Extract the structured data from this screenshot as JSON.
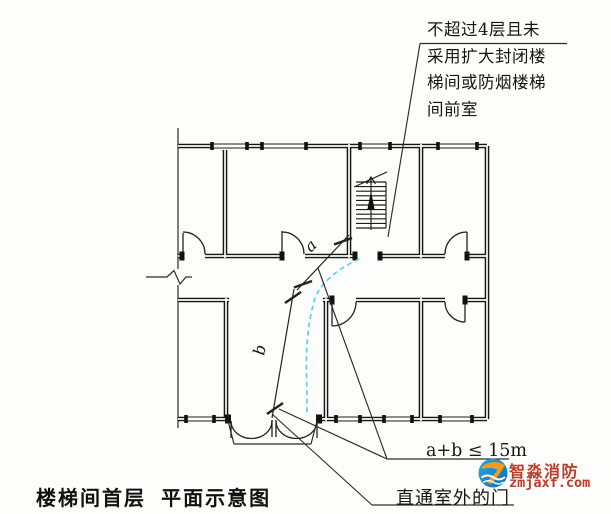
{
  "figure": {
    "caption": "楼梯间首层  平面示意图",
    "note": {
      "line1": "不超过4层且未",
      "line2": "采用扩大封闭楼",
      "line3": "梯间或防烟楼梯",
      "line4": "间前室"
    },
    "formula": "a+b ≤ 15m",
    "exit_label": "直通室外的门",
    "dim_a": "a",
    "dim_b": "b"
  },
  "watermark": {
    "brand": "智淼消防",
    "site": "zmjaxf.com"
  },
  "colors": {
    "ink": "#1c1c1c",
    "escape_path_cyan": "#49cfe9",
    "brand_red": "#c03a28",
    "logo_blue": "#1789cc",
    "logo_orange": "#f2991f"
  }
}
